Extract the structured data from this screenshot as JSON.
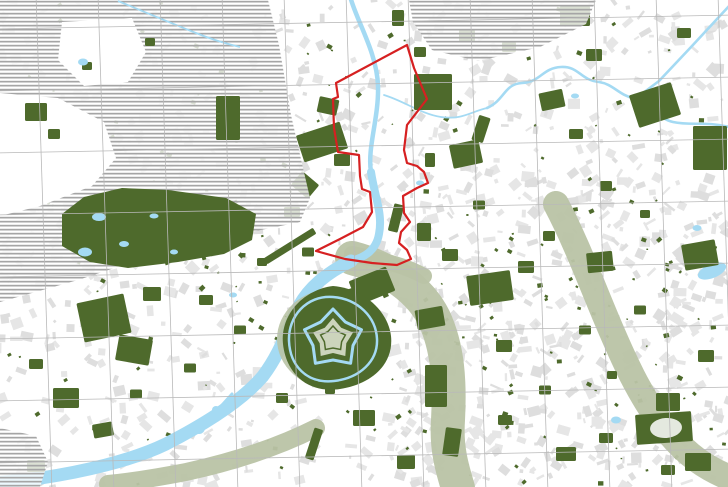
{
  "meta": {
    "title": "Urban analysis map with red project-site boundary, river corridor and star fortress",
    "width": 728,
    "height": 487
  },
  "colors": {
    "background": "#ffffff",
    "building_gray": "#e6e6e6",
    "building_gray_alt": "#dedede",
    "park_green": "#4e6a2c",
    "valley_sage": "#b9c3a5",
    "citadel_inner_sage": "#ccd4bc",
    "water_blue": "#a4daf3",
    "hatch_line": "#a5a5a5",
    "grid_line": "#b9b9b9",
    "boundary_red": "#d62021"
  },
  "grid": {
    "spacing": 62,
    "v_start_x": 36,
    "v_count": 12,
    "v_skew": 16,
    "h_start_y": 29,
    "h_count": 8,
    "h_skew": -14
  },
  "fabric": {
    "seed": 7,
    "count_uniform": 950,
    "count_cluster": 260,
    "cluster": [
      380,
      180,
      348,
      307
    ],
    "min_size": 2,
    "max_size": 13,
    "speck_count": 170,
    "speck_cluster_count": 60,
    "speck_cluster": [
      380,
      240,
      348,
      247
    ]
  },
  "features": {
    "hatch_areas": [
      {
        "name": "hatched-region-northwest",
        "d": "M0,0 L268,0 L279,45 L291,115 L303,168 L310,198 L300,222 L256,231 L212,241 L148,257 L78,280 L0,302 Z"
      },
      {
        "name": "hatched-region-northeast",
        "d": "M409,0 L596,0 L586,24 L540,47 L478,61 L432,50 L413,22 Z"
      },
      {
        "name": "hatched-region-southwest-corner",
        "d": "M0,428 L36,436 L48,462 L40,487 L0,487 Z"
      }
    ],
    "hatch_islands": [
      {
        "name": "village-clearing-west",
        "d": "M62,22 L132,18 L146,52 L128,82 L84,86 L58,60 Z"
      },
      {
        "name": "village-clearing-southwest",
        "d": "M0,93 L58,98 L104,122 L116,158 L92,186 L40,206 L0,216 Z"
      }
    ],
    "bois": {
      "name": "large-wooded-park",
      "d": "M62,214 L84,197 L122,188 L168,190 L226,198 L256,214 L252,240 L224,254 L178,262 L128,268 L90,262 L62,246 Z",
      "lakes": [
        [
          99,
          217,
          7,
          4,
          0
        ],
        [
          85,
          252,
          7,
          4.5,
          0
        ],
        [
          124,
          244,
          5,
          3,
          0
        ],
        [
          154,
          216,
          4.5,
          2.5,
          0
        ],
        [
          174,
          252,
          4,
          2.5,
          0
        ],
        [
          83,
          62,
          5,
          3.5,
          0
        ]
      ],
      "stream": {
        "d": "M118,1 C140,10 166,21 196,33 C216,41 228,44 240,47",
        "w": 1.8
      }
    },
    "post_hatch_greens": [
      [
        228,
        118,
        24,
        44,
        0
      ],
      [
        36,
        112,
        22,
        18,
        0
      ],
      [
        54,
        134,
        12,
        10,
        0
      ],
      [
        87,
        66,
        10,
        8,
        0
      ],
      [
        150,
        42,
        10,
        8,
        0
      ]
    ],
    "sage_paths": [
      {
        "name": "river-valley-corridor",
        "d": "M352,258 C390,268 420,290 434,318 C448,348 450,382 448,420 C446,448 452,468 458,488",
        "w": 34
      },
      {
        "name": "green-corridor-east",
        "d": "M556,204 C576,242 590,280 606,318 C622,356 640,398 668,432 C688,456 706,468 730,478",
        "w": 26
      },
      {
        "name": "river-bank-corridor-southwest",
        "d": "M316,428 C276,448 232,462 186,472 C150,479 128,482 108,484",
        "w": 18
      },
      {
        "name": "corridor-junction",
        "d": "M352,254 C380,260 402,264 424,276",
        "w": 16
      }
    ],
    "rivers": [
      {
        "name": "river-upper",
        "d": "M350,-4 C356,20 377,52 378,86 C379,118 367,148 371,172",
        "w": 4.5
      },
      {
        "name": "river-mid",
        "d": "M371,172 C375,198 383,214 379,234 C376,252 362,258 351,261",
        "w": 8
      },
      {
        "name": "river-lower",
        "d": "M351,261 C328,272 310,286 299,306 C287,330 281,352 263,376 C241,402 201,426 166,444 C131,461 81,472 41,478 L-5,483",
        "w": 13
      },
      {
        "name": "river-meander-northeast",
        "d": "M487,108 C505,100 504,84 522,83 C541,82 542,68 561,67 C579,66 580,80 599,82 C613,84 619,95 633,98 C652,103 656,118 673,122 C691,126 706,121 729,127",
        "w": 2.6
      },
      {
        "name": "straight-canal-northeast",
        "d": "M730,5 L692,46 L659,81 L635,99",
        "w": 2.6
      },
      {
        "name": "stream-link",
        "d": "M384,95 C404,101 421,114 441,117 C462,120 470,112 487,108",
        "w": 1.8
      },
      {
        "name": "dock-channel",
        "d": "M214,414 L232,394",
        "w": 3
      }
    ],
    "lakes": [
      [
        436,
        94,
        7,
        4.5,
        0
      ],
      [
        697,
        228,
        4.5,
        3,
        0
      ],
      [
        712,
        271,
        15,
        7,
        -22
      ],
      [
        616,
        420,
        5,
        3.5,
        0
      ],
      [
        575,
        96,
        4,
        2.5,
        0
      ],
      [
        233,
        295,
        4,
        2.5,
        0
      ],
      [
        199,
        428,
        6,
        6,
        0
      ],
      [
        216,
        410,
        4,
        4,
        0
      ],
      [
        420,
        183,
        4,
        2.5,
        0
      ]
    ],
    "green_patches": [
      [
        322,
        142,
        46,
        28,
        -18
      ],
      [
        328,
        106,
        20,
        16,
        12
      ],
      [
        342,
        160,
        16,
        12,
        0
      ],
      [
        305,
        185,
        22,
        18,
        40
      ],
      [
        292,
        212,
        16,
        10,
        0
      ],
      [
        290,
        246,
        58,
        7,
        -32
      ],
      [
        433,
        92,
        38,
        36,
        0
      ],
      [
        466,
        154,
        30,
        24,
        -12
      ],
      [
        467,
        36,
        16,
        12,
        0
      ],
      [
        509,
        47,
        14,
        10,
        0
      ],
      [
        481,
        129,
        12,
        26,
        18
      ],
      [
        552,
        100,
        24,
        18,
        -12
      ],
      [
        575,
        16,
        30,
        20,
        0
      ],
      [
        594,
        55,
        16,
        12,
        0
      ],
      [
        655,
        105,
        44,
        34,
        -18
      ],
      [
        684,
        33,
        14,
        10,
        0
      ],
      [
        710,
        148,
        34,
        44,
        0
      ],
      [
        396,
        218,
        10,
        28,
        14
      ],
      [
        424,
        232,
        14,
        18,
        0
      ],
      [
        450,
        255,
        16,
        12,
        0
      ],
      [
        490,
        288,
        44,
        30,
        -8
      ],
      [
        526,
        267,
        16,
        12,
        0
      ],
      [
        549,
        236,
        12,
        10,
        0
      ],
      [
        600,
        262,
        26,
        20,
        -6
      ],
      [
        66,
        398,
        26,
        20,
        0
      ],
      [
        103,
        430,
        20,
        14,
        -10
      ],
      [
        36,
        364,
        14,
        10,
        0
      ],
      [
        136,
        394,
        12,
        9,
        0
      ],
      [
        36,
        466,
        18,
        12,
        0
      ],
      [
        314,
        444,
        9,
        32,
        18
      ],
      [
        364,
        418,
        22,
        16,
        0
      ],
      [
        406,
        462,
        18,
        14,
        0
      ],
      [
        436,
        386,
        22,
        42,
        0
      ],
      [
        504,
        346,
        16,
        12,
        0
      ],
      [
        664,
        428,
        56,
        30,
        -4
      ],
      [
        700,
        255,
        34,
        26,
        -10
      ],
      [
        668,
        402,
        24,
        18,
        0
      ],
      [
        606,
        438,
        14,
        10,
        0
      ],
      [
        566,
        454,
        20,
        14,
        0
      ],
      [
        706,
        356,
        16,
        12,
        0
      ],
      [
        698,
        462,
        26,
        18,
        0
      ],
      [
        668,
        470,
        14,
        10,
        0
      ],
      [
        606,
        186,
        12,
        10,
        0
      ],
      [
        645,
        214,
        10,
        8,
        0
      ],
      [
        576,
        134,
        14,
        10,
        0
      ],
      [
        479,
        205,
        12,
        9,
        0
      ],
      [
        430,
        160,
        10,
        14,
        0
      ],
      [
        398,
        18,
        12,
        16,
        0
      ],
      [
        420,
        52,
        12,
        10,
        0
      ],
      [
        308,
        252,
        12,
        9,
        0
      ],
      [
        262,
        262,
        10,
        8,
        0
      ],
      [
        206,
        300,
        14,
        10,
        0
      ],
      [
        240,
        330,
        12,
        9,
        0
      ],
      [
        190,
        368,
        12,
        9,
        0
      ],
      [
        282,
        398,
        12,
        10,
        0
      ],
      [
        330,
        390,
        10,
        8,
        0
      ],
      [
        372,
        354,
        12,
        10,
        0
      ],
      [
        505,
        420,
        14,
        10,
        0
      ],
      [
        545,
        390,
        12,
        9,
        0
      ],
      [
        585,
        330,
        12,
        9,
        0
      ],
      [
        640,
        310,
        12,
        9,
        0
      ],
      [
        612,
        375,
        10,
        8,
        0
      ],
      [
        104,
        318,
        48,
        40,
        -12
      ],
      [
        134,
        350,
        34,
        26,
        10
      ],
      [
        152,
        294,
        18,
        14,
        0
      ],
      [
        372,
        286,
        40,
        26,
        -22
      ],
      [
        430,
        318,
        28,
        20,
        -10
      ],
      [
        452,
        442,
        16,
        28,
        8
      ]
    ],
    "white_ovals": [
      [
        666,
        428,
        16,
        10,
        -4
      ]
    ],
    "citadel": {
      "name": "star-fortress",
      "cx": 333,
      "cy": 339,
      "halo_rx": 56,
      "halo_ry": 50,
      "outer_blob": "M333,286 C362,288 388,310 391,336 C394,364 372,384 340,389 C306,394 286,372 283,344 C280,316 302,290 333,286 Z",
      "moat_ring": "M333,297 C358,299 376,317 377,339 C378,361 360,378 334,381 C306,384 290,365 289,341 C288,317 306,295 333,297",
      "moat_star": {
        "points": 5,
        "outer": 30,
        "inner": 21,
        "rot": -90,
        "w": 3
      },
      "inner_star": {
        "points": 5,
        "outer": 21,
        "inner": 14,
        "rot": -90
      },
      "core_star": {
        "points": 5,
        "outer": 13,
        "inner": 9,
        "rot": -90
      }
    },
    "boundary": {
      "name": "project-site-boundary",
      "d": "M407,45 L414,68 L427,99 L407,125 L404,150 L407,163 L417,166 L424,172 L428,183 L417,188 L403,196 L404,213 L410,222 L401,232 L399,243 L407,250 L411,259 L397,265 L372,263 L345,259 L316,251 L340,239 L363,227 L372,212 L370,192 L362,189 L360,176 L359,155 L338,152 L334,128 L333,99 L338,97 L336,83 Z",
      "stroke_width": 2.2
    }
  }
}
